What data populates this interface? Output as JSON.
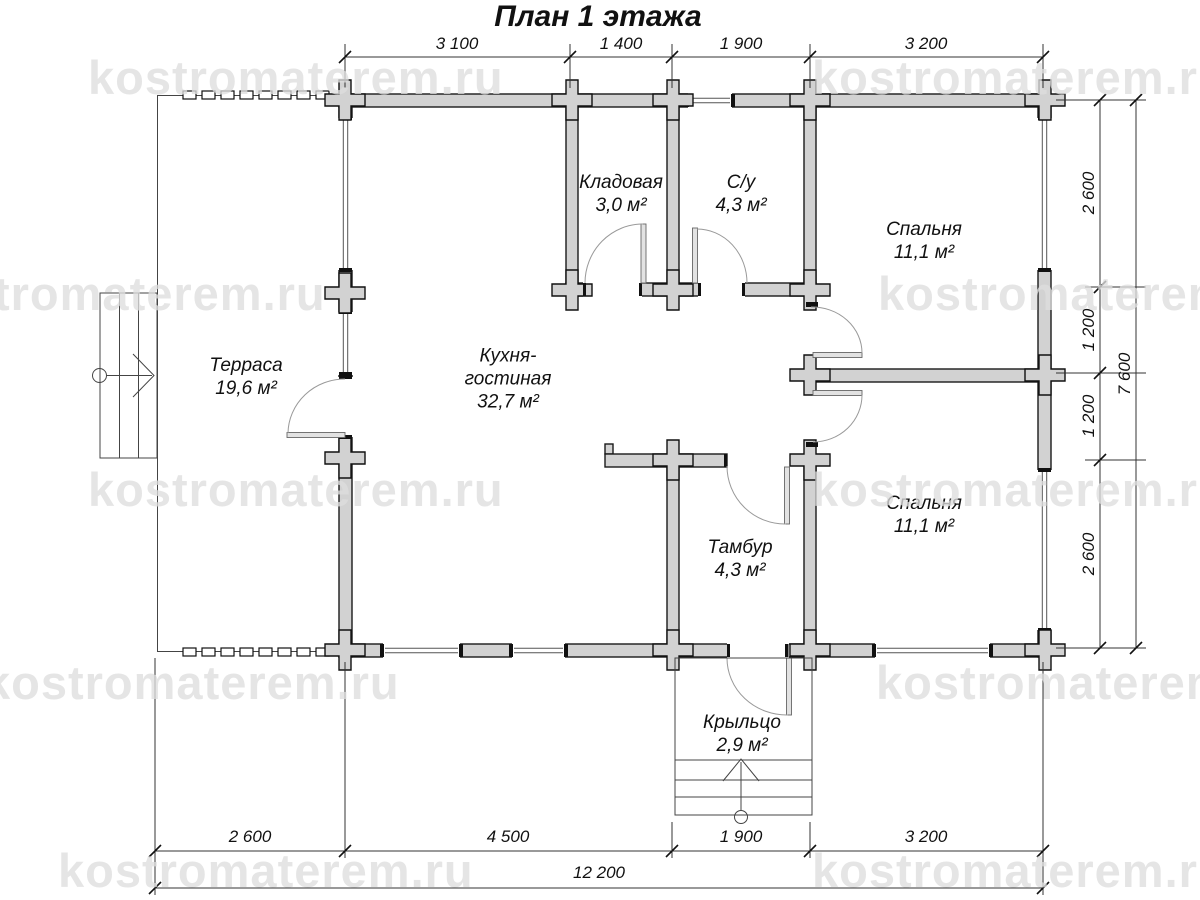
{
  "title": "План 1 этажа",
  "watermark": {
    "text": "kostromaterem.ru"
  },
  "rooms": {
    "terrace": {
      "name": "Терраса",
      "area": "19,6 м²"
    },
    "kitchen": {
      "line1": "Кухня-",
      "line2": "гостиная",
      "area": "32,7 м²"
    },
    "storage": {
      "name": "Кладовая",
      "area": "3,0 м²"
    },
    "bath": {
      "name": "С/у",
      "area": "4,3 м²"
    },
    "bedroom1": {
      "name": "Спальня",
      "area": "11,1 м²"
    },
    "bedroom2": {
      "name": "Спальня",
      "area": "11,1 м²"
    },
    "tambour": {
      "name": "Тамбур",
      "area": "4,3 м²"
    },
    "porch": {
      "name": "Крыльцо",
      "area": "2,9 м²"
    }
  },
  "dimensions": {
    "top": [
      "3 100",
      "1 400",
      "1 900",
      "3 200"
    ],
    "right": [
      "2 600",
      "1 200",
      "1 200",
      "2 600"
    ],
    "right_total": "7 600",
    "bottom": [
      "2 600",
      "4 500",
      "1 900",
      "3 200"
    ],
    "bottom_total": "12 200"
  },
  "colors": {
    "wall_fill": "#d2d2d2",
    "line": "#1a1a1a",
    "watermark": "#e3e3e3"
  }
}
